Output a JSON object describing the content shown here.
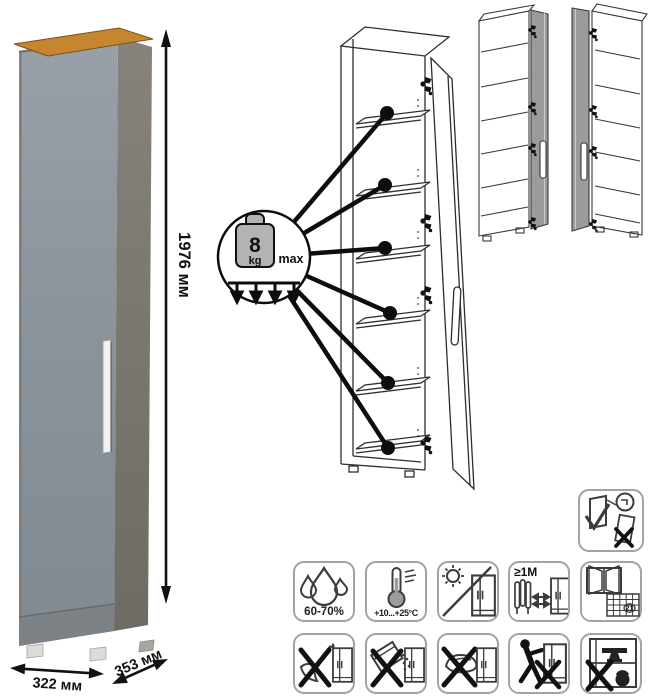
{
  "dimensions": {
    "height": "1976 мм",
    "width": "322 мм",
    "depth": "353 мм"
  },
  "shelf_load": {
    "weight": "8",
    "unit": "kg",
    "qualifier": "max"
  },
  "care": {
    "humidity_range": "60-70%",
    "temperature_range": "+10...+25°C",
    "min_heater_distance": "≥1М",
    "calendar_day": "21"
  },
  "colors": {
    "door_gray": "#8d959c",
    "side_gray": "#7e7a73",
    "wood_top": "#c5862f",
    "line_art": "#2e2e2e"
  }
}
